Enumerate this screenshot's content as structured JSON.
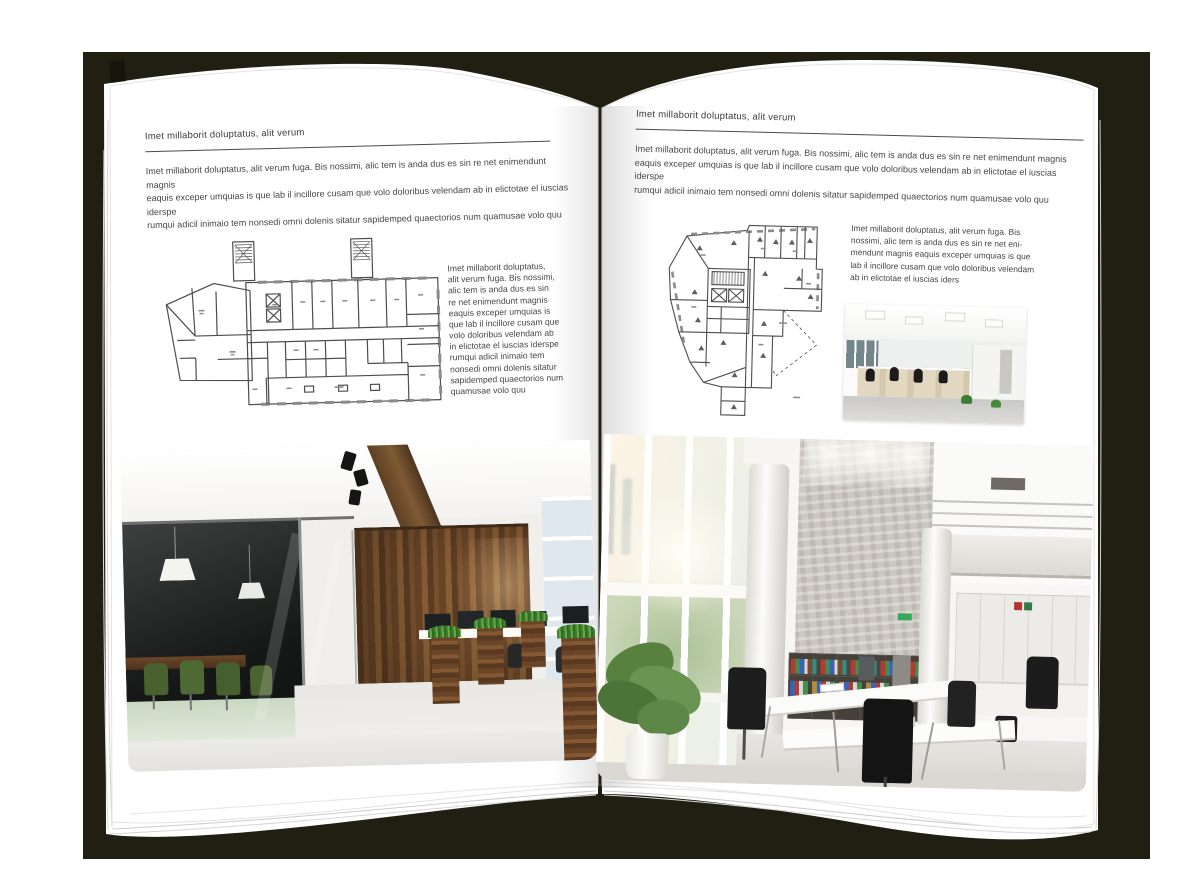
{
  "backdrop": {
    "color": "#201f12"
  },
  "book": {
    "left_page": {
      "header": "Imet millaborit doluptatus, alit verum",
      "intro_lines": [
        "Imet millaborit doluptatus, alit verum fuga. Bis nossimi, alic tem is anda dus es sin re net enimendunt magnis",
        "eaquis exceper umquias is que lab il incillore cusam que volo doloribus velendam ab in elictotae el iuscias iderspe",
        "rumqui adicil inimaio tem nonsedi omni dolenis sitatur sapidemped quaectorios num quamusae volo quu"
      ],
      "side_text_lines": [
        "Imet millaborit doluptatus,",
        "alit verum fuga. Bis nossimi,",
        "alic tem is anda dus es sin",
        "re net enimendunt magnis",
        "eaquis exceper umquias is",
        "que lab il incillore cusam que",
        "volo doloribus velendam ab",
        "in elictotae el iuscias iderspe",
        "rumqui adicil inimaio tem",
        "nonsedi omni dolenis sitatur",
        "sapidemped quaectorios num",
        "quamusae volo quu"
      ],
      "images": {
        "floorplan": "architectural-floor-plan-drawing",
        "photo_large": "office-interior-wood-wall-glass-meeting-room"
      }
    },
    "right_page": {
      "header": "Imet millaborit doluptatus, alit verum",
      "intro_lines": [
        "Imet millaborit doluptatus, alit verum fuga. Bis nossimi, alic tem is anda dus es sin re net enimendunt magnis",
        "eaquis exceper umquias is que lab il incillore cusam que volo doloribus velendam ab in elictotae el iuscias iderspe",
        "rumqui adicil inimaio tem nonsedi omni dolenis sitatur sapidemped quaectorios num quamusae volo quu"
      ],
      "side_text_lines": [
        "Imet millaborit doluptatus, alit verum fuga. Bis",
        "nossimi, alic tem is anda dus es sin re net eni-",
        "mendunt magnis eaquis exceper umquias is que",
        "lab il incillore cusam que volo doloribus velendam",
        "ab in elictotae el iuscias iders"
      ],
      "images": {
        "floorplan": "architectural-floor-plan-drawing",
        "photo_small": "open-space-office-desks-photo",
        "photo_large": "bright-atrium-office-photo"
      }
    }
  }
}
